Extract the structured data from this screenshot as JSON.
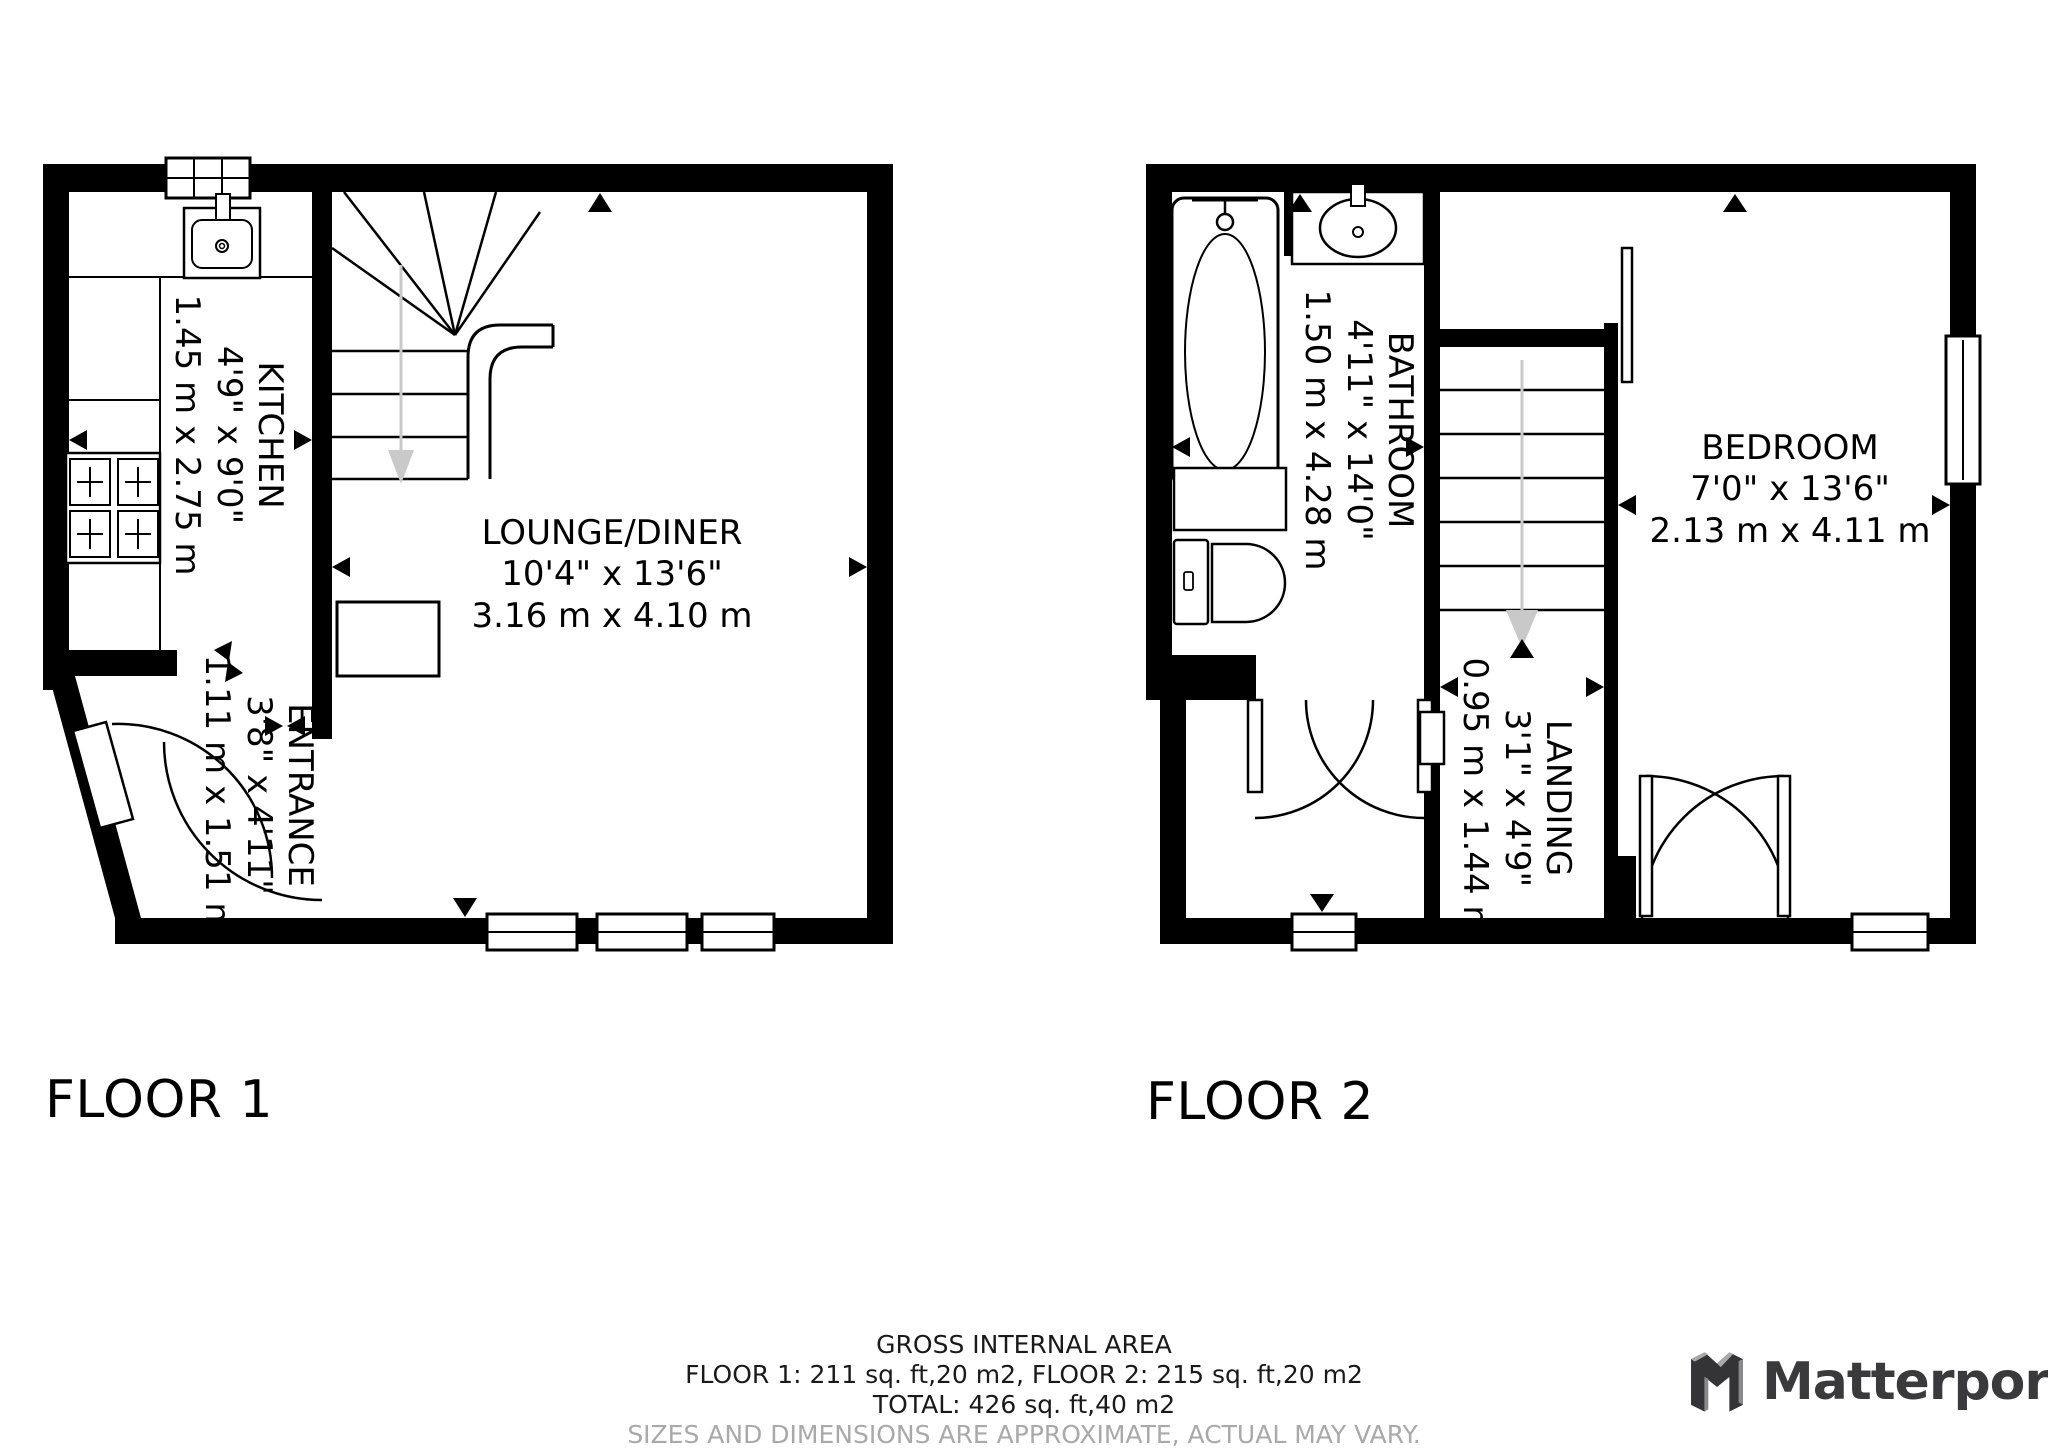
{
  "floor1": {
    "label": "FLOOR 1",
    "rooms": {
      "kitchen": {
        "name": "KITCHEN",
        "dim_ft": "4'9\" x 9'0\"",
        "dim_m": "1.45 m x 2.75 m"
      },
      "lounge": {
        "name": "LOUNGE/DINER",
        "dim_ft": "10'4\" x 13'6\"",
        "dim_m": "3.16 m x 4.10 m"
      },
      "entrance": {
        "name": "ENTRANCE",
        "dim_ft": "3'8\" x 4'11\"",
        "dim_m": "1.11 m x 1.51 m"
      }
    }
  },
  "floor2": {
    "label": "FLOOR 2",
    "rooms": {
      "bathroom": {
        "name": "BATHROOM",
        "dim_ft": "4'11\" x 14'0\"",
        "dim_m": "1.50 m x 4.28 m"
      },
      "landing": {
        "name": "LANDING",
        "dim_ft": "3'1\" x 4'9\"",
        "dim_m": "0.95 m x 1.44 m"
      },
      "bedroom": {
        "name": "BEDROOM",
        "dim_ft": "7'0\" x 13'6\"",
        "dim_m": "2.13 m x 4.11 m"
      }
    }
  },
  "footer": {
    "title": "GROSS INTERNAL AREA",
    "floors_line": "FLOOR 1: 211 sq. ft,20 m2, FLOOR 2: 215 sq. ft,20 m2",
    "total_line": "TOTAL: 426 sq. ft,40 m2",
    "disclaimer": "SIZES AND DIMENSIONS ARE APPROXIMATE, ACTUAL MAY VARY."
  },
  "brand": {
    "name": "Matterport"
  },
  "colors": {
    "wall": "#000000",
    "stair_arrow": "#c9c9c9",
    "disclaimer_text": "#a9a9a9",
    "logo_text": "#3a3a3c"
  }
}
